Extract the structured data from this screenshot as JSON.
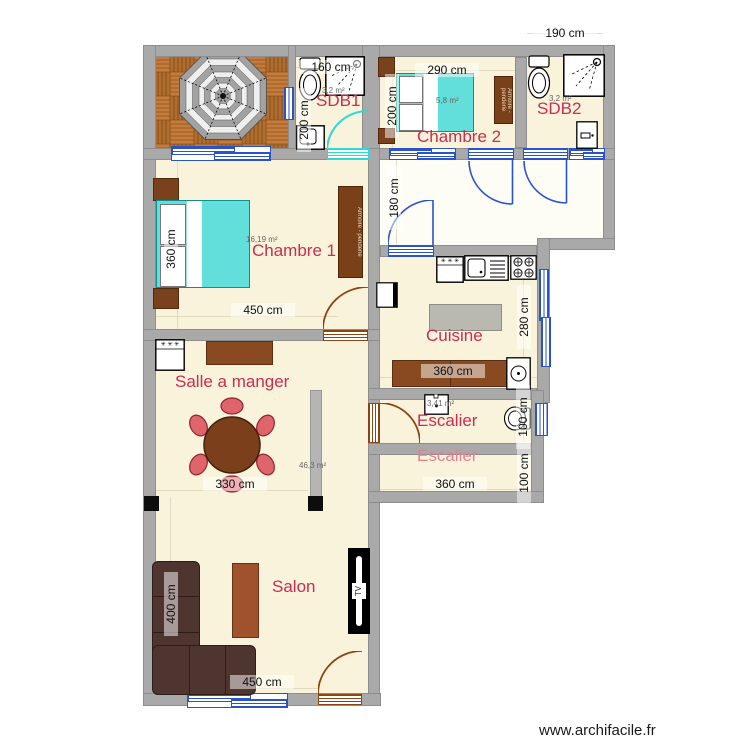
{
  "watermark": "www.archifacile.fr",
  "colors": {
    "floor": "#f8f3da",
    "wall": "#a9a9a9",
    "room_label": "#c92d52",
    "room_label_light": "#e28290",
    "door_blue": "#2a52cc",
    "door_brown": "#8b4513",
    "selection_cyan": "#2bd9d9",
    "bed_cyan": "#63dfdb",
    "wood": "#bd7637"
  },
  "rooms": {
    "sdb1": {
      "label": "SDB1",
      "area": "3,2 m²"
    },
    "chambre2": {
      "label": "Chambre 2",
      "area": "5,8 m²"
    },
    "sdb2": {
      "label": "SDB2",
      "area": "3,2 m²"
    },
    "chambre1": {
      "label": "Chambre 1",
      "area": "16,19 m²"
    },
    "cuisine": {
      "label": "Cuisine"
    },
    "salle_a_manger": {
      "label": "Salle a manger",
      "area": "46,3 m²"
    },
    "escalier1": {
      "label": "Escalier",
      "area": "3,41 m²"
    },
    "escalier2": {
      "label": "Escalier"
    },
    "salon": {
      "label": "Salon"
    }
  },
  "dimensions": {
    "sdb1_width": "160 cm",
    "sdb1_depth": "200 cm",
    "sdb2_width": "190 cm",
    "chambre2_width": "290 cm",
    "chambre2_bed": "200 cm",
    "hall_depth": "180 cm",
    "chambre1_depth": "360 cm",
    "chambre1_width": "450 cm",
    "cuisine_depth": "280 cm",
    "cuisine_width": "360 cm",
    "escalier1_depth": "100 cm",
    "salle_width": "330 cm",
    "escalier2_width": "360 cm",
    "escalier2_depth": "100 cm",
    "salon_depth": "400 cm",
    "salon_width": "450 cm"
  },
  "furniture": {
    "wardrobe_chambre1": "Armoire - penderie",
    "wardrobe_chambre2": "Armoire - penderie",
    "tv": "TV"
  },
  "icons": {
    "freezer_stars": "✳ ✳ ✳"
  }
}
